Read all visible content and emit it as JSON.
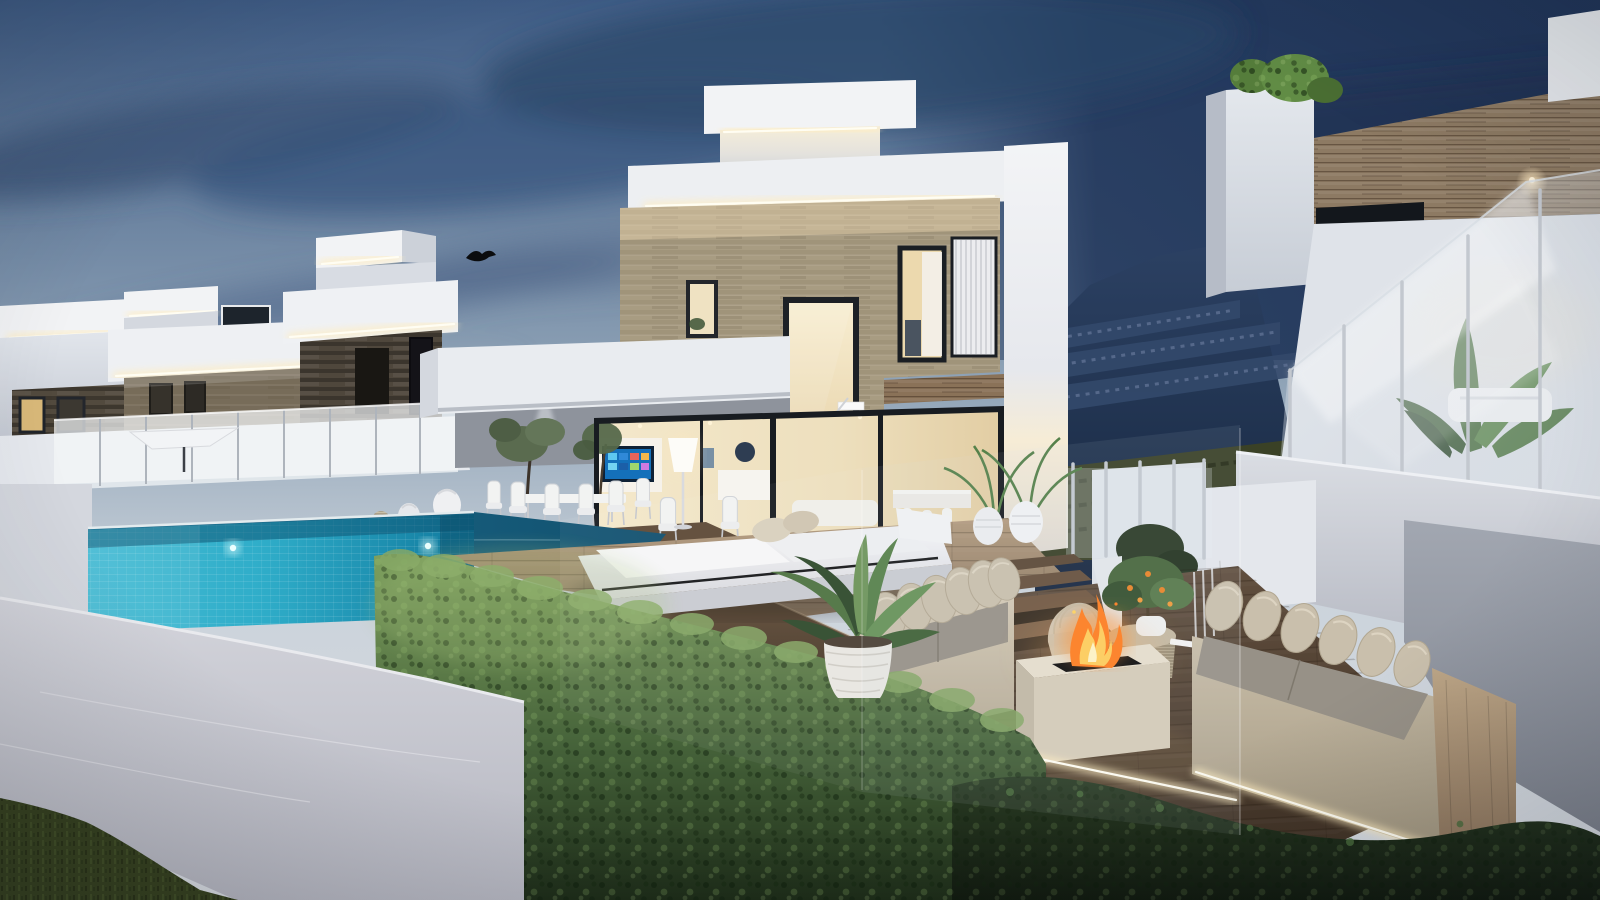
{
  "scene": {
    "label": "modern-luxury-villas-dusk-3d-render",
    "type": "architectural-exterior-render",
    "time_of_day": "dusk",
    "objects": [
      "twilight-sky",
      "cloud-streaks",
      "mountain-hillside-with-buildings",
      "row-of-white-villas-left",
      "central-two-story-villa",
      "right-villa-with-glass-balcony",
      "stone-accent-walls",
      "led-cove-lighting",
      "infinity-pool-with-acrylic-wall",
      "underwater-pool-lights",
      "glass-balustrades",
      "white-parasol",
      "outdoor-dining-set",
      "tv-wall-interior",
      "floor-lamp",
      "white-daybed",
      "wood-deck",
      "sunken-lounge",
      "beige-sofas-with-gray-cushions",
      "stone-fire-pit-with-flames",
      "rattan-side-table",
      "orange-tree-in-pot",
      "potted-palms",
      "boxwood-hedge",
      "dark-hedge-row",
      "white-perimeter-wall",
      "lawn-grass",
      "rooftop-shrubs",
      "banana-plants"
    ]
  },
  "palette": {
    "sky_top": "#3f5c85",
    "sky_mid": "#8ea2b6",
    "sky_horizon": "#cbd3db",
    "sky_navy": "#21365a",
    "cloud_dark": "#3a5375",
    "mountain_top": "#2c4163",
    "mountain_bottom": "#16263e",
    "hillside_hedge": "#3a4126",
    "villa_white": "#f2f3f5",
    "villa_shade": "#d8dce3",
    "villa_gray": "#b7bcc7",
    "led_warm": "#ffedc0",
    "led_core": "#fffdf2",
    "stone_light": "#b0a489",
    "stone_dark": "#524a3e",
    "window_frame": "#1d2126",
    "interior_warm": "#f2e5c7",
    "interior_deep": "#e3cfa6",
    "pool_tile": "#2fadc9",
    "pool_deep": "#117a9e",
    "water_dark": "#11506e",
    "deck_light": "#a68e74",
    "deck_walnut": "#5d4936",
    "lounge_floor": "#564536",
    "wood_wall": "#8d7a63",
    "hedge_light": "#7ea05e",
    "hedge_mid": "#46633a",
    "hedge_dark": "#1d2c18",
    "grass": "#36411f",
    "wall_light": "#d3d4db",
    "wall_shade": "#b5b6c0",
    "sofa_beige": "#ccc1ad",
    "cushion_gray": "#979187",
    "wood_panel": "#b49d7f",
    "fire_orange": "#ff7d1f",
    "fire_yellow": "#ffd25e",
    "glass_tint": "#e9eef3",
    "steel": "#c3c8cf",
    "plant_green": "#4f7342",
    "plant_dark": "#2f4a2c",
    "tv_blue": "#1470ba"
  }
}
